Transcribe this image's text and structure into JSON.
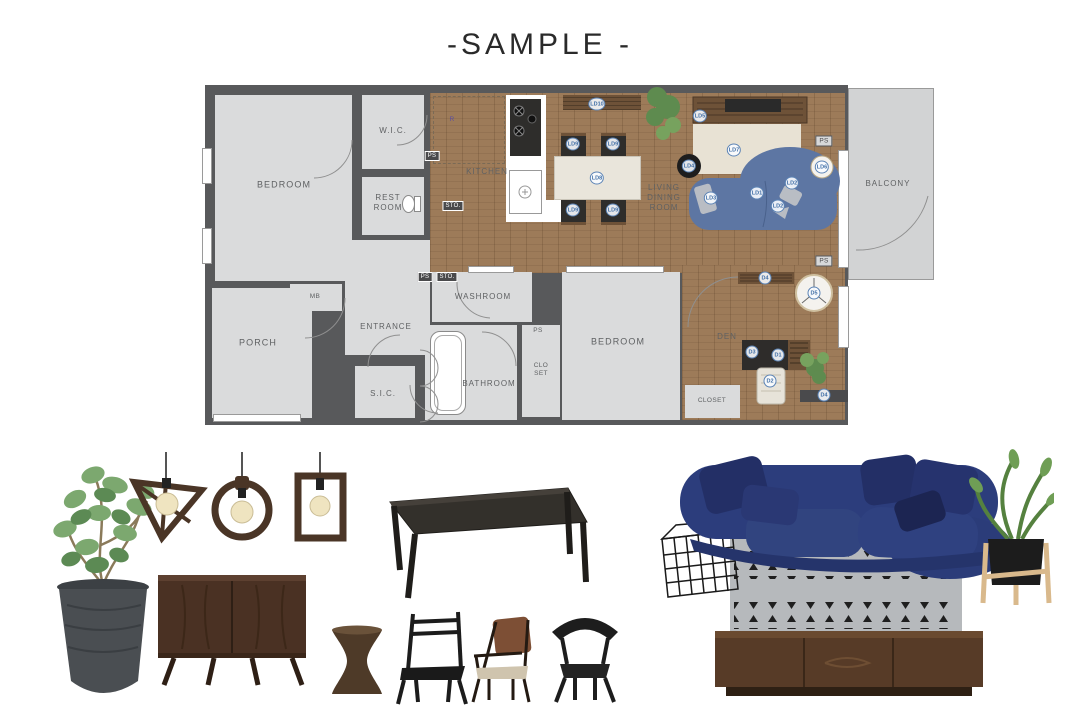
{
  "title": "-SAMPLE -",
  "plan": {
    "rooms": {
      "bedroom": "BEDROOM",
      "wic": "W.I.C.",
      "restroom": "REST ROOM",
      "kitchen": "KITCHEN",
      "living": "LIVING DINING ROOM",
      "balcony": "BALCONY",
      "porch": "PORCH",
      "mb": "MB",
      "entrance": "ENTRANCE",
      "sic": "S.I.C.",
      "washroom": "WASHROOM",
      "bathroom": "BATHROOM",
      "closet": "CLOSET",
      "closet_split": "CLO SET",
      "bedroom2": "BEDROOM",
      "den": "DEN",
      "ps": "PS",
      "sto": "STO.",
      "r": "R"
    },
    "markers": {
      "ld1": "LD1",
      "ld2": "LD2",
      "ld3": "LD3",
      "ld4": "LD4",
      "ld5": "LD5",
      "ld6": "LD6",
      "ld7": "LD7",
      "ld8": "LD8",
      "ld9": "LD9",
      "ld10": "LD10",
      "d1": "D1",
      "d2": "D2",
      "d3": "D3",
      "d4": "D4",
      "d5": "D5"
    }
  }
}
